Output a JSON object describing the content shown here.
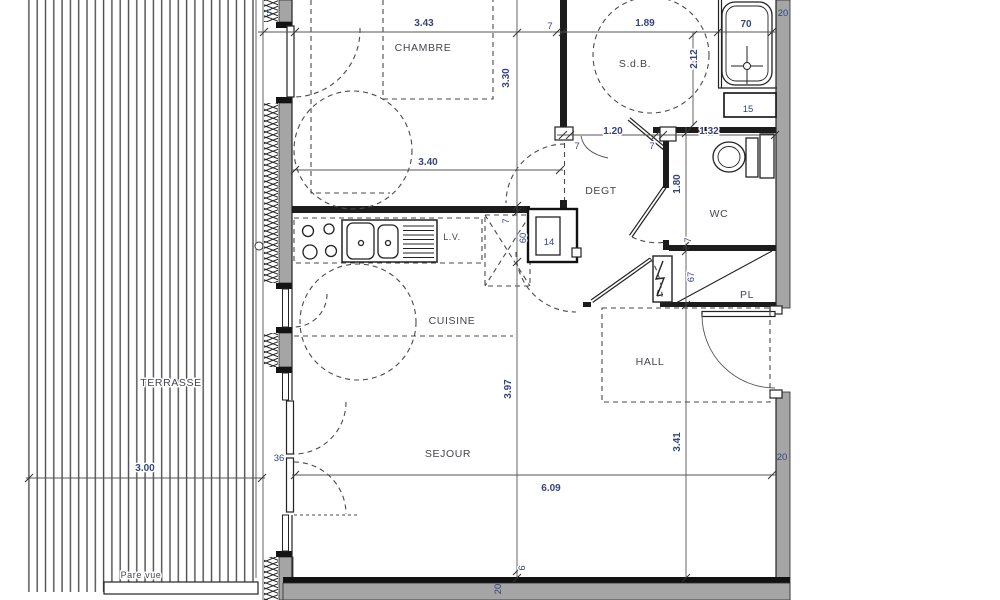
{
  "plan": {
    "rooms": {
      "terrasse": "TERRASSE",
      "chambre": "CHAMBRE",
      "sdb": "S.d.B.",
      "degt": "DEGT",
      "wc": "WC",
      "pl": "PL",
      "hall": "HALL",
      "cuisine": "CUISINE",
      "sejour": "SEJOUR"
    },
    "labels": {
      "dishwasher": "L.V.",
      "privacy_screen": "Pare vue"
    },
    "dims": {
      "d343": "3.43",
      "d7a": "7",
      "d189": "1.89",
      "d70": "70",
      "d20top": "20",
      "d5": "5",
      "d330": "3.30",
      "d212": "2.12",
      "d340": "3.40",
      "d7b": "7",
      "d120": "1.20",
      "d7c": "7",
      "d132": "1.32",
      "d180": "1.80",
      "d7d": "7",
      "d67": "67",
      "d15": "15",
      "d14": "14",
      "d60": "60",
      "d7e": "7",
      "d397": "3.97",
      "d6": "6",
      "d20bot": "20",
      "d341": "3.41",
      "d609": "6.09",
      "d300": "3.00",
      "d36": "36",
      "d20right": "20"
    },
    "colors": {
      "wall_fill": "#a5a5a5",
      "wall_line": "#1c1c1c",
      "dim_text": "#35457f",
      "room_text": "#45454f"
    }
  }
}
